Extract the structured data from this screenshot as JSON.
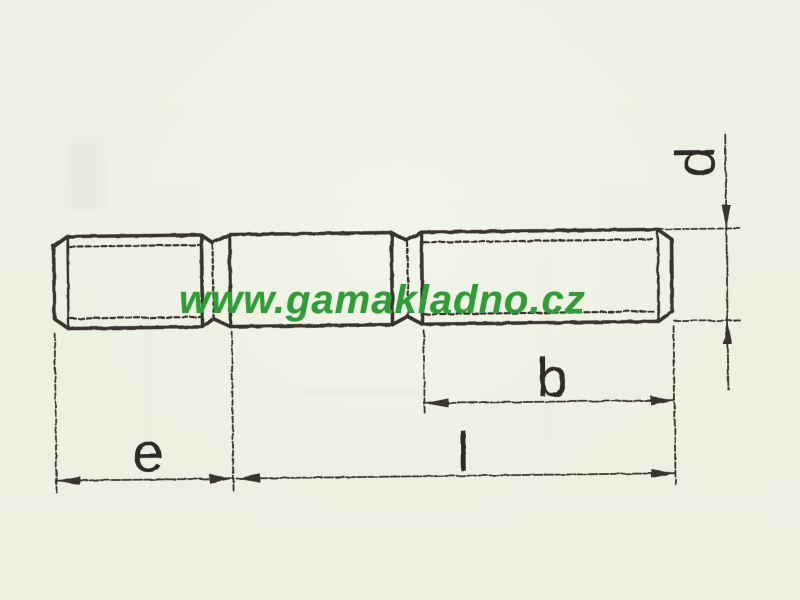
{
  "page": {
    "background_color": "#eef0e3"
  },
  "watermark": {
    "text": "www.gamakladno.cz",
    "color": "#2f9e36"
  },
  "drawing": {
    "line_color": "#38352d",
    "labels": {
      "d": "d",
      "b": "b",
      "l": "l",
      "e": "e"
    }
  }
}
